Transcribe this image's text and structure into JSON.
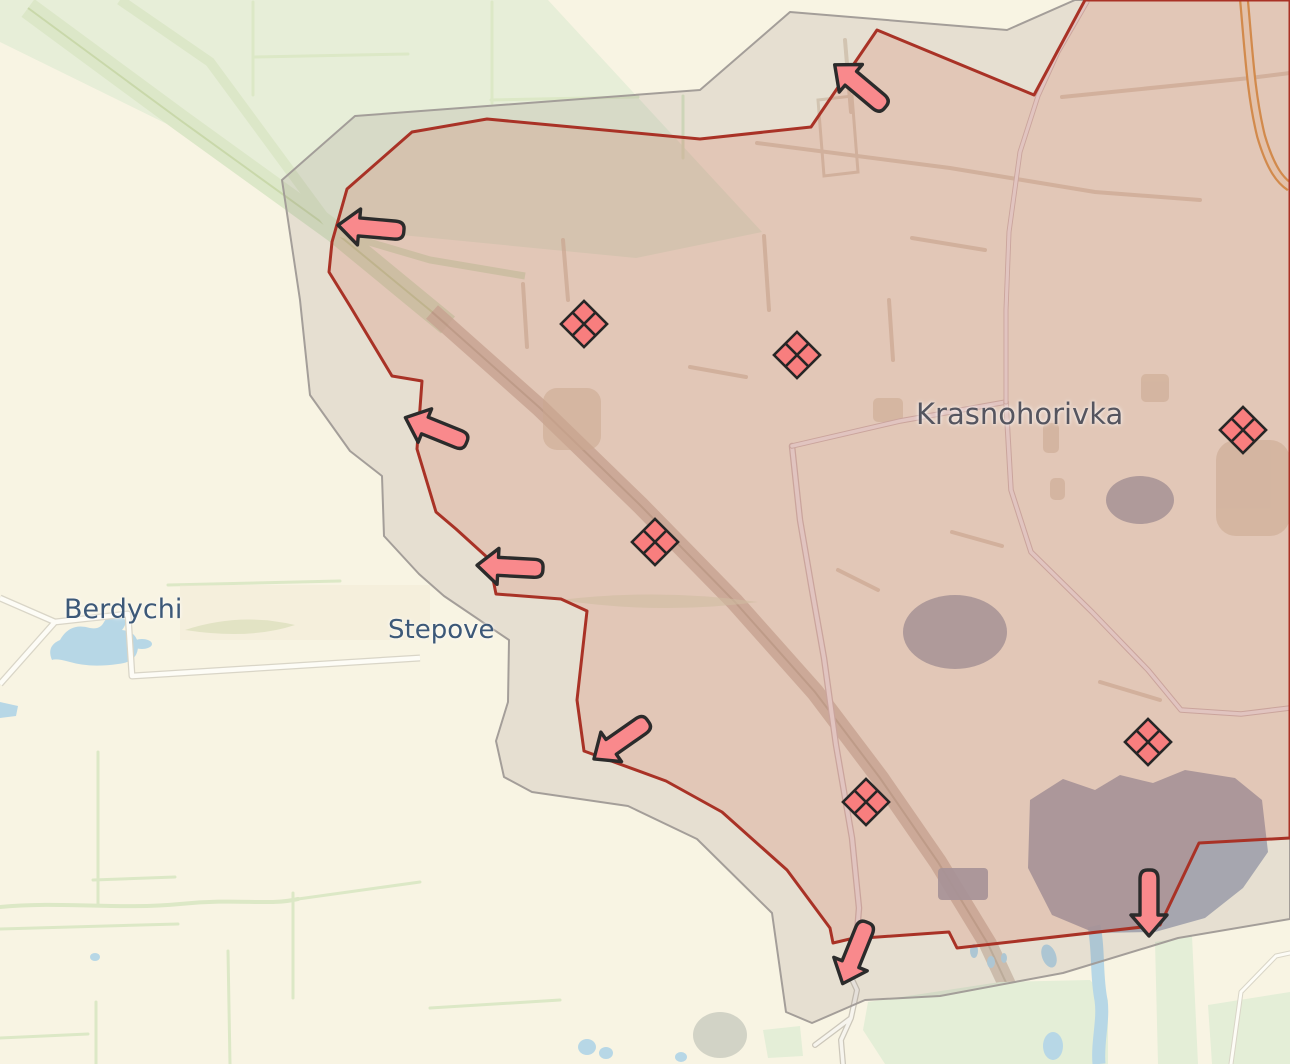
{
  "title": "Frontline map near Krasnohorivka",
  "map": {
    "places": {
      "berdychi": {
        "label": "Berdychi"
      },
      "stepove": {
        "label": "Stepove"
      },
      "krasnohorivka": {
        "label": "Krasnohorivka"
      }
    },
    "zones": {
      "occupied": {
        "name": "occupied-area",
        "fill": "rgba(204,74,48,0.16)",
        "border": "#a93226"
      },
      "grey": {
        "name": "grey-buffer-zone",
        "fill": "rgba(116,92,92,0.14)",
        "border": "#a09a96"
      }
    },
    "markers": {
      "unit_fill": "#f87e7e",
      "arrow_fill": "#f9898c",
      "outline": "#2b2b2b",
      "units": [
        {
          "x": 584,
          "y": 324
        },
        {
          "x": 797,
          "y": 355
        },
        {
          "x": 1243,
          "y": 430
        },
        {
          "x": 655,
          "y": 542
        },
        {
          "x": 1148,
          "y": 742
        },
        {
          "x": 866,
          "y": 802
        }
      ],
      "arrows": [
        {
          "x": 860,
          "y": 86,
          "rot": 40
        },
        {
          "x": 371,
          "y": 228,
          "rot": 5
        },
        {
          "x": 436,
          "y": 430,
          "rot": 22
        },
        {
          "x": 510,
          "y": 567,
          "rot": 3
        },
        {
          "x": 621,
          "y": 740,
          "rot": -35
        },
        {
          "x": 855,
          "y": 953,
          "rot": -68
        },
        {
          "x": 1149,
          "y": 903,
          "rot": -90
        }
      ]
    },
    "base_colors": {
      "land": "#f8f4e3",
      "water": "#b7d7e6",
      "greenery": "#e4eed7",
      "railway_corridor": "#dce7c8",
      "urban_industrial": "#a6abb7",
      "highway": "#e2a050"
    }
  }
}
